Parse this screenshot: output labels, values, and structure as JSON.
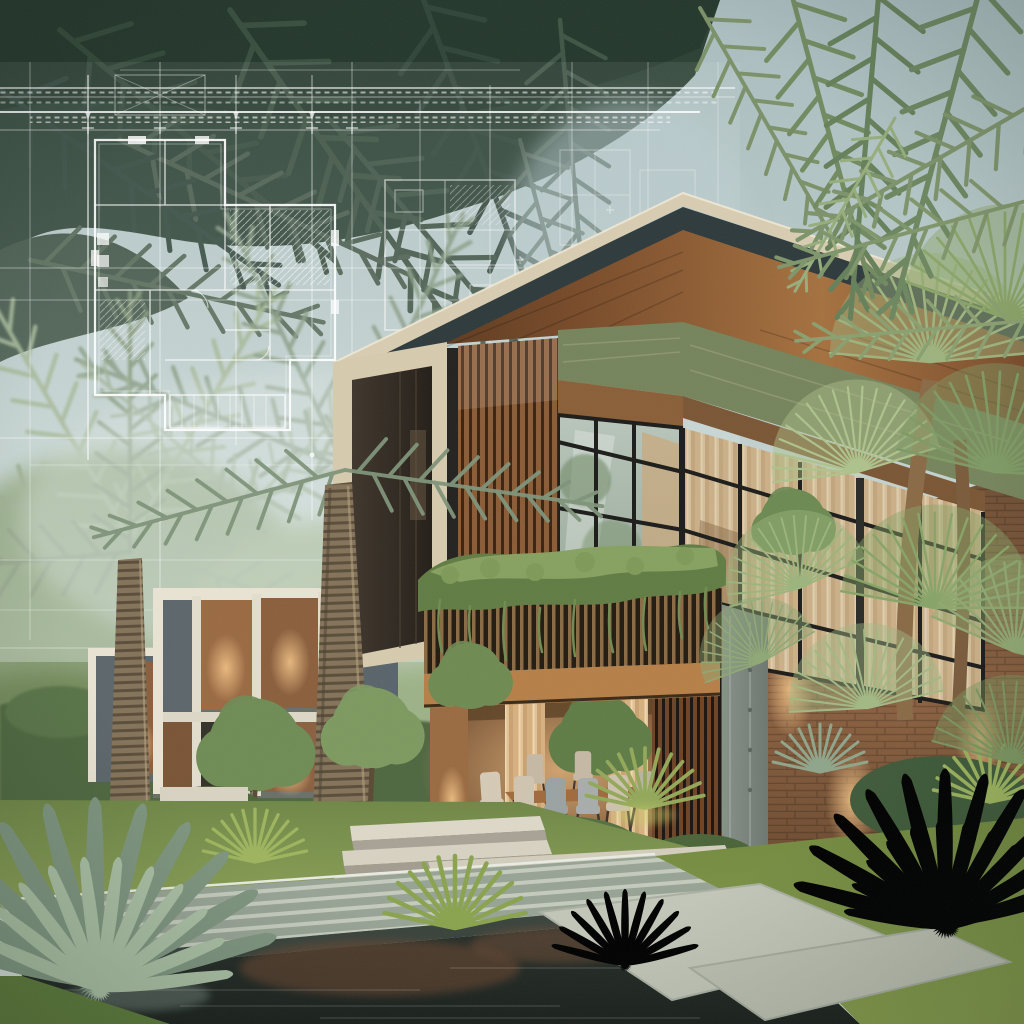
{
  "scene": {
    "title": "Modern tropical villa — architectural concept render",
    "description": "Photorealistic dusk rendering of a two-story cantilevered villa with wood-slat facade, glass curtain walls, planted balcony and warm interior lighting; a translucent white blueprint floor-plan overlay floats over dark palm canopy at upper left; secondary modular pavilions, royal palm trunks, fan palms, agaves, lawn, stone walkway and a dark reflecting water channel fill the foreground.",
    "style": "photorealistic architectural visualization with blueprint overlay",
    "time_of_day": "dusk with warm accent lighting",
    "elements": [
      "blueprint floor-plan overlay",
      "cantilevered upper volume",
      "cream roof edge",
      "dark fascia",
      "wood soffit",
      "green concrete band",
      "wood slat wall",
      "glass curtain wall with curtains",
      "balcony planter with trailing vines",
      "slat balcony railing",
      "outdoor dining set",
      "concrete pier",
      "secondary framed pavilions",
      "royal palm trunks",
      "palm crowns",
      "fan palm cluster",
      "agave plants",
      "spiky shrubs",
      "lawn",
      "striped stone walkway",
      "reflecting water channel",
      "stone paving",
      "entry steps",
      "wall uplights"
    ]
  },
  "palette": {
    "sky_top": "#a9bcbe",
    "sky_mid": "#c2d1cf",
    "sky_low": "#d4ddd6",
    "canopy_deep": "#25382c",
    "canopy_dark": "#33483a",
    "canopy_mid": "#44584a",
    "canopy_light": "#5d7257",
    "frond_olive": "#72895f",
    "frond_sage": "#8aa070",
    "frond_bright": "#9cb37c",
    "blueprint_line": "#ffffff",
    "blueprint_haze": "#e8f1ef",
    "roof_cream": "#d8cdb2",
    "fascia_dark": "#2e3a3c",
    "concrete_green": "#76845c",
    "lintel_wood": "#8a5f38",
    "frame_cream": "#d7cbae",
    "opening_dark": "#312a22",
    "slat_wood": "#7a5130",
    "slat_dark": "#2e2418",
    "window_frame": "#1c1c1a",
    "glass_cool": "#a3b2a7",
    "curtain_warm": "#d9b98c",
    "planter_green": "#617c44",
    "planter_light": "#86a160",
    "concrete_grey": "#87918a",
    "wall_warm": "#7a5536",
    "glow_warm": "#ffd9a0",
    "floor_warm": "#c8a878",
    "chair_beige": "#d5cab6",
    "chair_grey": "#9aa2a2",
    "table_wood": "#8a5a34",
    "building_frame": "#e9e3d3",
    "building_panel": "#5c666b",
    "building_warm": "#9a6a43",
    "trunk_light": "#8a795c",
    "trunk_dark": "#5f5340",
    "hedge_dark": "#4f6840",
    "lawn_mid": "#7b9150",
    "lawn_front": "#7d9448",
    "lawn_deep": "#5d7a3a",
    "deck_stone": "#97a395",
    "deck_edge": "#39433c",
    "water_deep": "#232a25",
    "water_warm": "#6e4a32",
    "water_sheen": "#9fb3ac",
    "paving_light": "#c2c6b8",
    "agave_green": "#8ea58c",
    "agave_light": "#a9bfa3",
    "agave_blue": "#93ab91",
    "spiky_green": "#9db45e",
    "fan_dark": "#6f8a5c",
    "fan_mid": "#88a468",
    "fan_light": "#a8bd8a",
    "steps_light": "#ddd8c8",
    "steps_shadow": "#a8a296",
    "plinth": "#d3cdbc",
    "brick_warm": "#8a5f3e"
  }
}
